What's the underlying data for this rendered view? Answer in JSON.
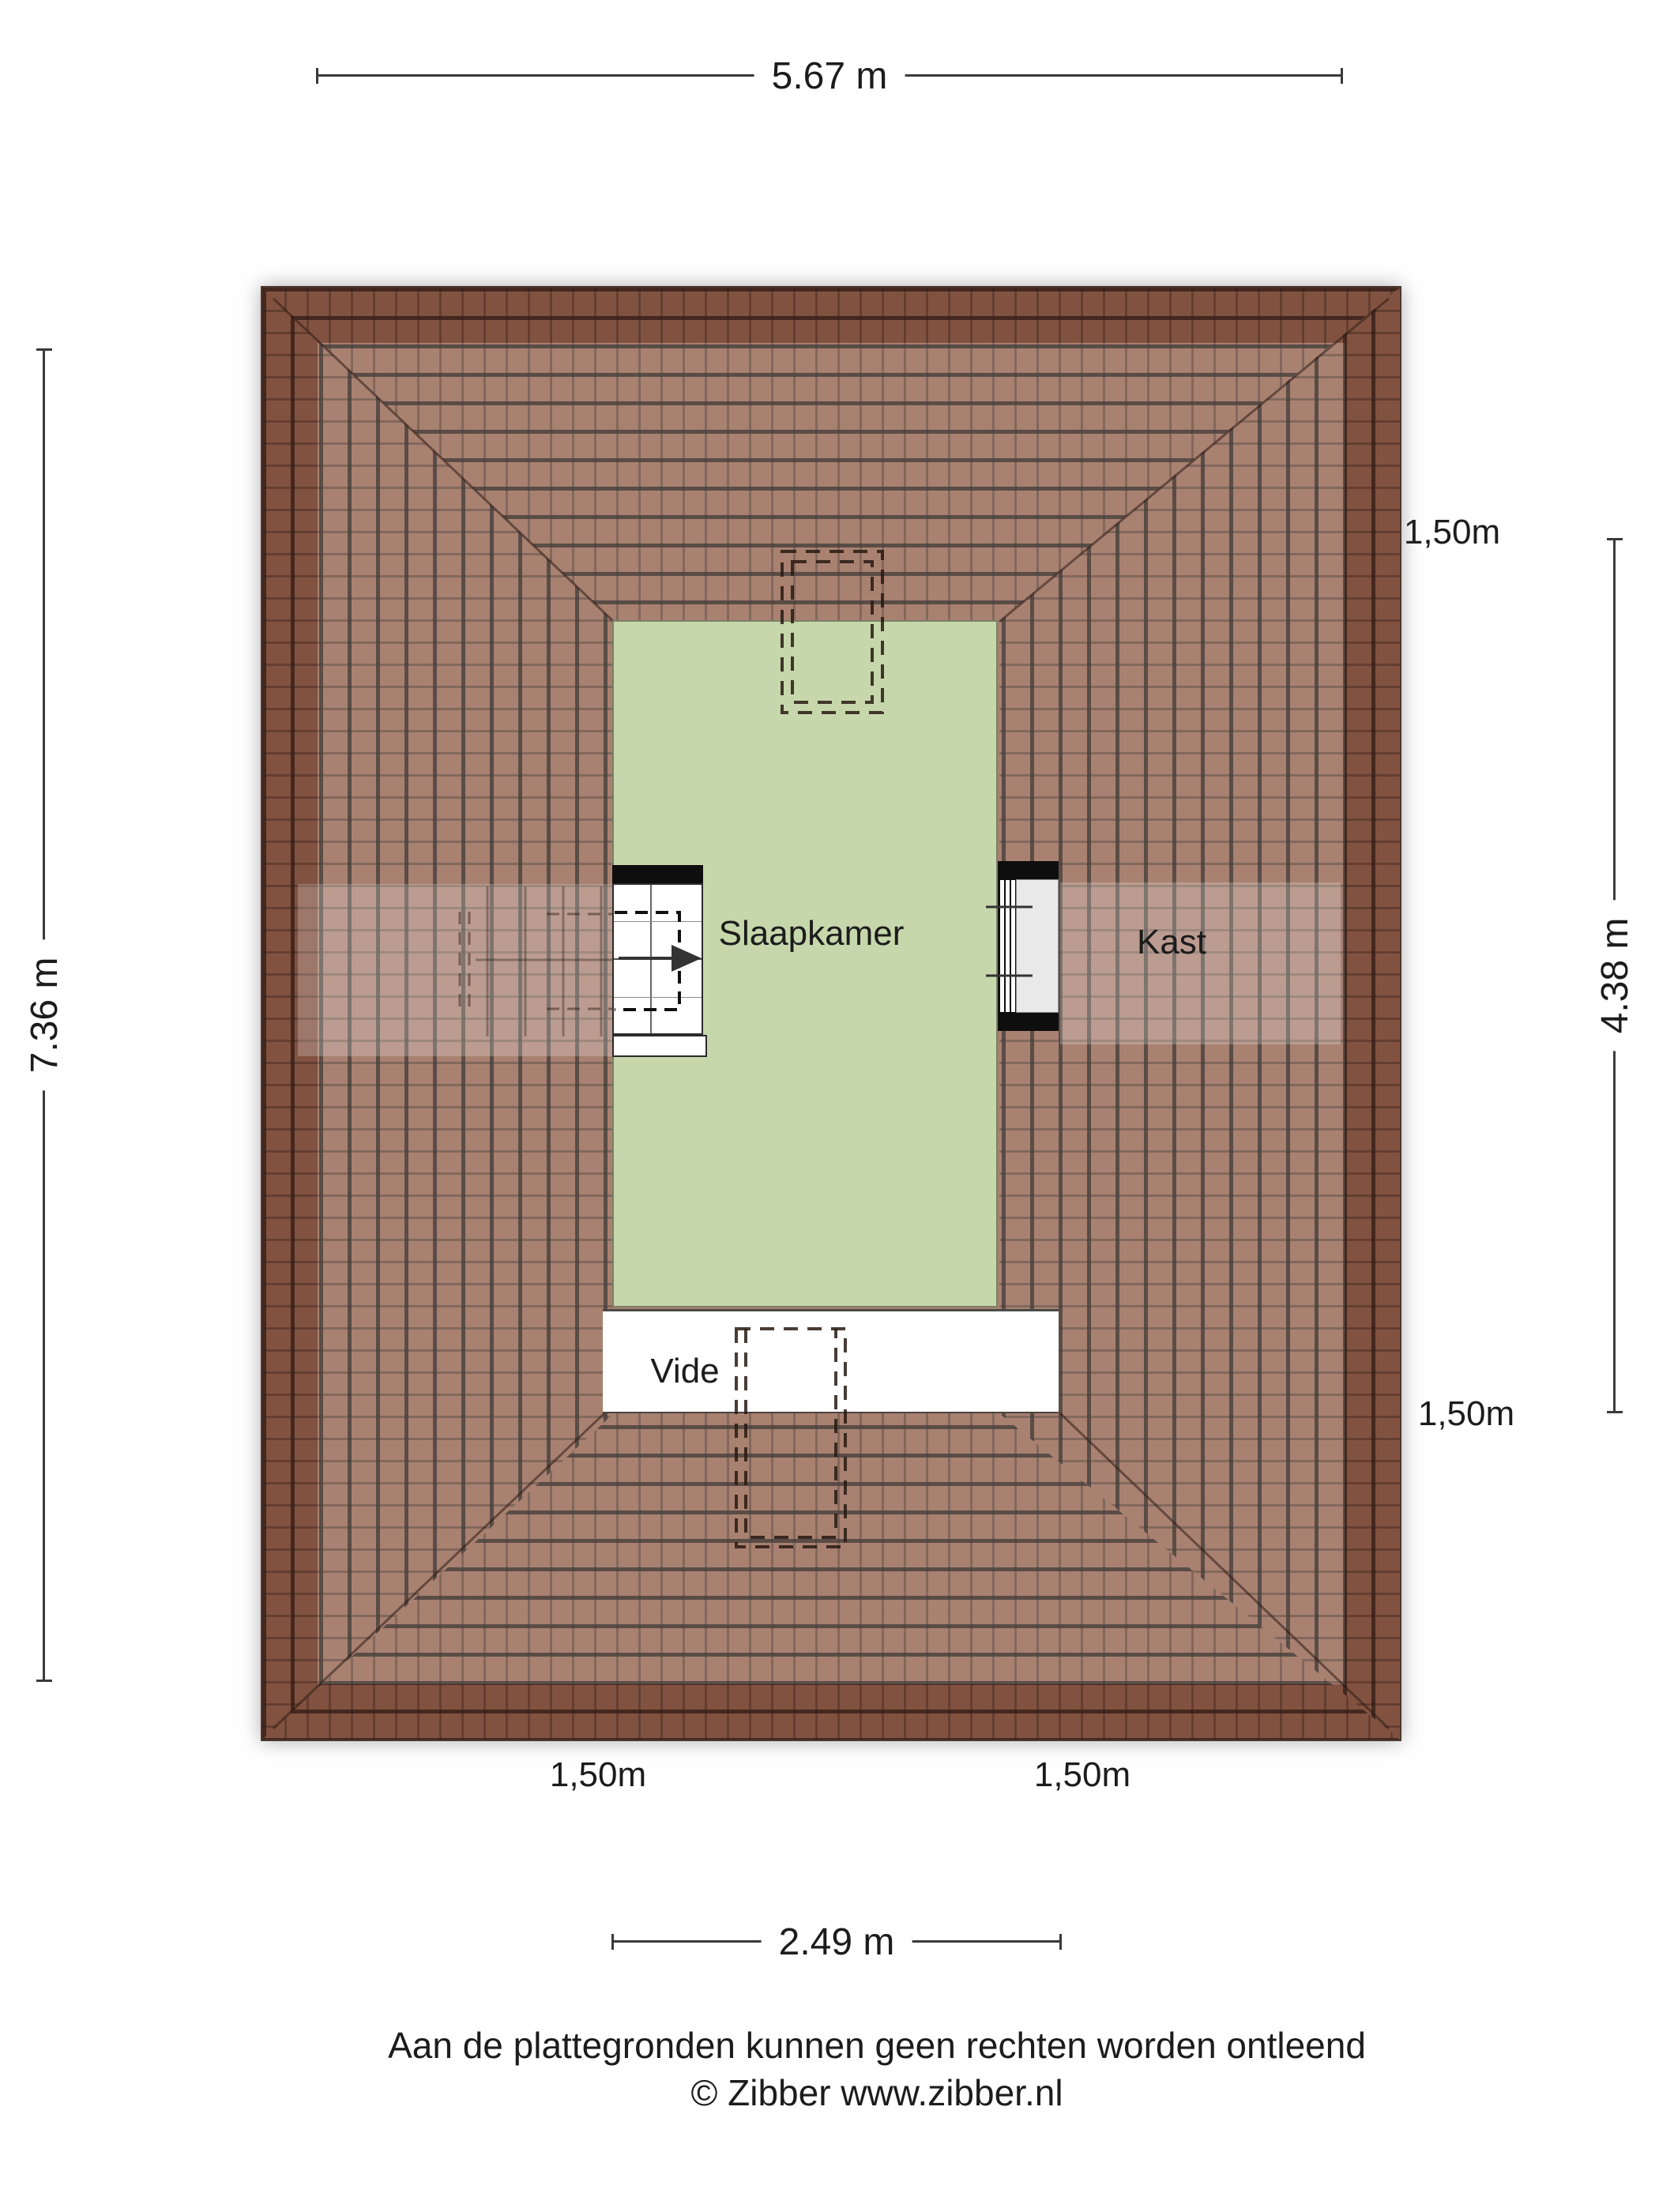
{
  "dimensions": {
    "top": "5.67 m",
    "left": "7.36 m",
    "right": "4.38 m",
    "bottom": "2.49 m",
    "height_lines": {
      "right_top": "1,50m",
      "right_bottom": "1,50m",
      "bottom_left": "1,50m",
      "bottom_right": "1,50m"
    }
  },
  "rooms": {
    "bedroom": "Slaapkamer",
    "closet": "Kast",
    "void": "Vide"
  },
  "footer": {
    "line1": "Aan de plattegronden kunnen geen rechten worden ontleend",
    "line2": "© Zibber www.zibber.nl"
  },
  "colors": {
    "roof_tile": "#9a6c59",
    "roof_eaves": "rgba(82,30,18,0.33)",
    "floor_green": "#c6d7ac",
    "line": "#3a3a3a"
  }
}
